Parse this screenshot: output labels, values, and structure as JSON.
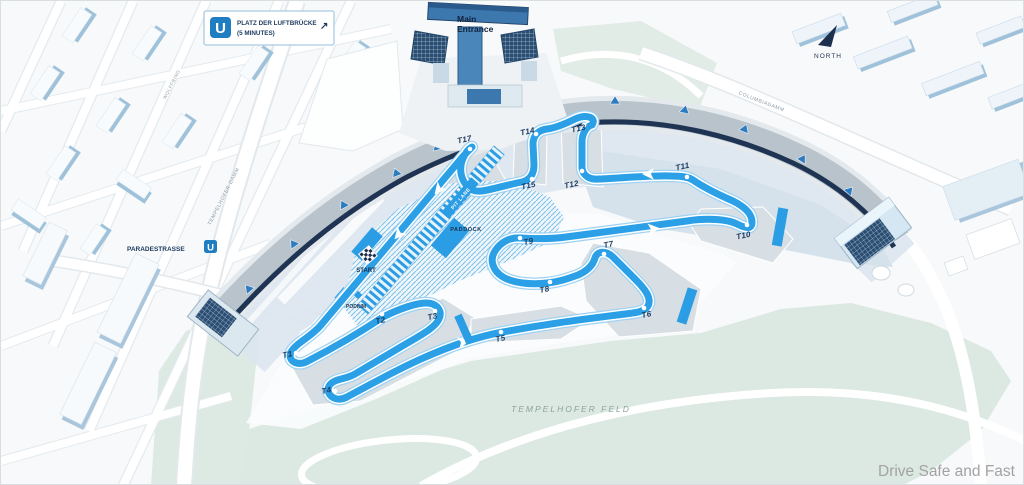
{
  "map": {
    "ubahn_box": {
      "line1": "PLATZ DER LUFTBRÜCKE",
      "line2": "(5 MINUTES)",
      "u_icon": "U",
      "arrow": "↗"
    },
    "north_label": "NORTH",
    "entrance": {
      "line1": "Main",
      "line2": "Entrance"
    },
    "streets": {
      "paradestrasse": "PARADESTRASSE",
      "paradestrasse_u_icon": "U",
      "tempelhofer_damm": "TEMPELHOFER DAMM",
      "wolffring": "WOLFFRING",
      "columbiadamm": "COLUMBIADAMM"
    },
    "areas": {
      "tempelhofer_feld": "TEMPELHOFER FELD"
    },
    "circuit": {
      "pit_lane": "PIT LANE",
      "paddock": "PADDOCK",
      "start": "START",
      "podium": "PODIUM",
      "turns": [
        {
          "label": "T1"
        },
        {
          "label": "T2"
        },
        {
          "label": "T3"
        },
        {
          "label": "T4"
        },
        {
          "label": "T5"
        },
        {
          "label": "T6"
        },
        {
          "label": "T7"
        },
        {
          "label": "T8"
        },
        {
          "label": "T9"
        },
        {
          "label": "T10"
        },
        {
          "label": "T11"
        },
        {
          "label": "T12"
        },
        {
          "label": "T13"
        },
        {
          "label": "T14"
        },
        {
          "label": "T15"
        },
        {
          "label": "T16"
        },
        {
          "label": "T17"
        }
      ]
    },
    "watermark": "Drive Safe and Fast",
    "colors": {
      "track_blue": "#2ba0e6",
      "navy": "#1c3a5e",
      "ubahn_blue": "#1f7ec2"
    }
  }
}
